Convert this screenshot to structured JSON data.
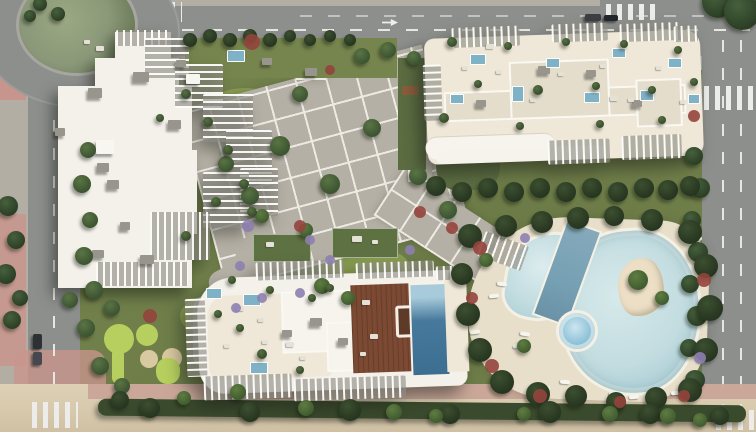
{
  "scene": {
    "description": "Aerial 3D render of a beachfront residential complex: three white apartment buildings with louvered rooftop terraces and plunge pools, a central paved plaza, landscaped gardens, a free-form lagoon pool with lap lane, jacuzzi and palm island, perimeter roads with a roundabout and crosswalks, and a sandy beach strip along the bottom",
    "palette": {
      "road": "#8d8f8c",
      "sidewalk": "#b2aea4",
      "pink": "#c8958c",
      "pinkPath": "#c7a094",
      "building": "#f3f1ea",
      "cream": "#efe7d7",
      "roofVol": "#e4ddcc",
      "roofBox": "#98958c",
      "lawn": "#76854e",
      "lawnBright": "#9cb457",
      "putting": "#b6cf5e",
      "paver": "#b5b0a5",
      "paverLine": "#eceae3",
      "poolLight": "#c2dce0",
      "poolMid": "#7fb2c6",
      "poolLap": "#76a0b4",
      "poolDark": "#47799c",
      "jacuzzi": "#8ec2d8",
      "sandDeck": "#e8dfca",
      "beach": "#d8c9ad",
      "islandSand": "#ecdfc6",
      "wood": "#7c4a33",
      "purple": "#8d80b0",
      "red": "#93443c",
      "greenRoof": "#5e7143",
      "darkLawn": "#5b6c41",
      "hedgeStrip": "#3a4a2c",
      "roundaboutIsland": "#8b9879"
    },
    "treeShades": {
      "dark": [
        "#46603c",
        "#2a3d24"
      ],
      "mid": [
        "#5a7444",
        "#3a5230"
      ],
      "hedge": [
        "#3c4f30",
        "#25341f"
      ],
      "planter": [
        "#55703f",
        "#36492c"
      ],
      "palm": [
        "#5f7c42",
        "#3f5a2e"
      ]
    },
    "vegetation": [
      [
        694,
        156,
        9,
        "dark"
      ],
      [
        700,
        188,
        10,
        "dark"
      ],
      [
        692,
        220,
        9,
        "dark"
      ],
      [
        698,
        252,
        10,
        "dark"
      ],
      [
        690,
        284,
        9,
        "dark"
      ],
      [
        697,
        316,
        10,
        "dark"
      ],
      [
        689,
        348,
        9,
        "dark"
      ],
      [
        695,
        380,
        10,
        "dark"
      ],
      [
        718,
        2,
        16,
        "dark"
      ],
      [
        742,
        12,
        18,
        "dark"
      ],
      [
        8,
        206,
        10,
        "dark"
      ],
      [
        16,
        240,
        9,
        "dark"
      ],
      [
        6,
        274,
        10,
        "dark"
      ],
      [
        20,
        298,
        8,
        "dark"
      ],
      [
        12,
        320,
        9,
        "dark"
      ],
      [
        40,
        4,
        7,
        "dark"
      ],
      [
        58,
        14,
        7,
        "dark"
      ],
      [
        30,
        16,
        6,
        "dark"
      ],
      [
        470,
        236,
        12,
        "hedge"
      ],
      [
        462,
        274,
        11,
        "hedge"
      ],
      [
        468,
        314,
        12,
        "hedge"
      ],
      [
        480,
        350,
        12,
        "hedge"
      ],
      [
        502,
        382,
        12,
        "hedge"
      ],
      [
        538,
        394,
        12,
        "hedge"
      ],
      [
        576,
        396,
        11,
        "hedge"
      ],
      [
        616,
        402,
        10,
        "hedge"
      ],
      [
        656,
        398,
        11,
        "hedge"
      ],
      [
        690,
        390,
        12,
        "hedge"
      ],
      [
        706,
        350,
        12,
        "hedge"
      ],
      [
        710,
        308,
        13,
        "hedge"
      ],
      [
        706,
        266,
        12,
        "hedge"
      ],
      [
        690,
        232,
        12,
        "hedge"
      ],
      [
        652,
        220,
        11,
        "hedge"
      ],
      [
        614,
        216,
        10,
        "hedge"
      ],
      [
        578,
        218,
        11,
        "hedge"
      ],
      [
        542,
        222,
        11,
        "hedge"
      ],
      [
        506,
        226,
        11,
        "hedge"
      ],
      [
        436,
        186,
        10,
        "hedge"
      ],
      [
        462,
        192,
        10,
        "hedge"
      ],
      [
        488,
        188,
        10,
        "hedge"
      ],
      [
        514,
        192,
        10,
        "hedge"
      ],
      [
        540,
        188,
        10,
        "hedge"
      ],
      [
        566,
        192,
        10,
        "hedge"
      ],
      [
        592,
        188,
        10,
        "hedge"
      ],
      [
        618,
        192,
        10,
        "hedge"
      ],
      [
        644,
        188,
        10,
        "hedge"
      ],
      [
        668,
        190,
        10,
        "hedge"
      ],
      [
        690,
        186,
        10,
        "hedge"
      ],
      [
        190,
        40,
        7,
        "hedge"
      ],
      [
        210,
        36,
        7,
        "hedge"
      ],
      [
        230,
        40,
        7,
        "hedge"
      ],
      [
        250,
        36,
        7,
        "hedge"
      ],
      [
        270,
        40,
        7,
        "hedge"
      ],
      [
        290,
        36,
        6,
        "hedge"
      ],
      [
        310,
        40,
        6,
        "hedge"
      ],
      [
        330,
        36,
        6,
        "hedge"
      ],
      [
        350,
        40,
        6,
        "hedge"
      ],
      [
        280,
        146,
        10,
        "mid"
      ],
      [
        330,
        184,
        10,
        "mid"
      ],
      [
        250,
        196,
        9,
        "mid"
      ],
      [
        372,
        128,
        9,
        "mid"
      ],
      [
        418,
        176,
        9,
        "mid"
      ],
      [
        448,
        210,
        9,
        "mid"
      ],
      [
        300,
        94,
        8,
        "mid"
      ],
      [
        226,
        164,
        8,
        "mid"
      ],
      [
        362,
        56,
        8,
        "mid"
      ],
      [
        388,
        50,
        8,
        "mid"
      ],
      [
        414,
        58,
        7,
        "mid"
      ],
      [
        88,
        150,
        8,
        "mid"
      ],
      [
        82,
        184,
        9,
        "mid"
      ],
      [
        90,
        220,
        8,
        "mid"
      ],
      [
        84,
        256,
        9,
        "mid"
      ],
      [
        94,
        290,
        9,
        "mid"
      ],
      [
        112,
        308,
        8,
        "mid"
      ],
      [
        86,
        328,
        9,
        "mid"
      ],
      [
        100,
        366,
        9,
        "mid"
      ],
      [
        122,
        386,
        8,
        "mid"
      ],
      [
        70,
        300,
        8,
        "mid"
      ],
      [
        150,
        408,
        10,
        "hedge"
      ],
      [
        250,
        412,
        10,
        "hedge"
      ],
      [
        350,
        410,
        11,
        "hedge"
      ],
      [
        450,
        414,
        10,
        "hedge"
      ],
      [
        550,
        412,
        11,
        "hedge"
      ],
      [
        650,
        414,
        10,
        "hedge"
      ],
      [
        720,
        416,
        9,
        "hedge"
      ],
      [
        120,
        400,
        9,
        "hedge"
      ],
      [
        322,
        286,
        8,
        "palm"
      ],
      [
        348,
        298,
        7,
        "palm"
      ],
      [
        262,
        216,
        7,
        "palm"
      ],
      [
        306,
        230,
        7,
        "palm"
      ],
      [
        638,
        280,
        10,
        "palm"
      ],
      [
        662,
        298,
        7,
        "palm"
      ],
      [
        486,
        260,
        7,
        "palm"
      ],
      [
        524,
        346,
        7,
        "palm"
      ],
      [
        238,
        392,
        8,
        "palm"
      ],
      [
        306,
        408,
        8,
        "palm"
      ],
      [
        394,
        412,
        8,
        "palm"
      ],
      [
        436,
        416,
        7,
        "palm"
      ],
      [
        524,
        414,
        7,
        "palm"
      ],
      [
        610,
        414,
        8,
        "palm"
      ],
      [
        668,
        416,
        8,
        "palm"
      ],
      [
        700,
        420,
        7,
        "palm"
      ],
      [
        184,
        398,
        7,
        "palm"
      ],
      [
        452,
        42,
        5,
        "planter"
      ],
      [
        478,
        84,
        4,
        "planter"
      ],
      [
        508,
        46,
        4,
        "planter"
      ],
      [
        538,
        90,
        5,
        "planter"
      ],
      [
        566,
        42,
        4,
        "planter"
      ],
      [
        596,
        86,
        4,
        "planter"
      ],
      [
        624,
        44,
        4,
        "planter"
      ],
      [
        652,
        90,
        4,
        "planter"
      ],
      [
        678,
        50,
        4,
        "planter"
      ],
      [
        694,
        82,
        4,
        "planter"
      ],
      [
        444,
        118,
        5,
        "planter"
      ],
      [
        520,
        126,
        4,
        "planter"
      ],
      [
        600,
        124,
        4,
        "planter"
      ],
      [
        662,
        120,
        4,
        "planter"
      ],
      [
        232,
        280,
        4,
        "planter"
      ],
      [
        270,
        290,
        4,
        "planter"
      ],
      [
        312,
        298,
        4,
        "planter"
      ],
      [
        240,
        328,
        4,
        "planter"
      ],
      [
        262,
        354,
        5,
        "planter"
      ],
      [
        300,
        370,
        4,
        "planter"
      ],
      [
        330,
        288,
        4,
        "planter"
      ],
      [
        218,
        314,
        4,
        "planter"
      ],
      [
        186,
        94,
        5,
        "planter"
      ],
      [
        208,
        122,
        5,
        "planter"
      ],
      [
        228,
        150,
        5,
        "planter"
      ],
      [
        244,
        184,
        5,
        "planter"
      ],
      [
        252,
        212,
        5,
        "planter"
      ],
      [
        216,
        202,
        5,
        "planter"
      ],
      [
        186,
        236,
        5,
        "planter"
      ],
      [
        160,
        118,
        4,
        "planter"
      ]
    ],
    "flowers": [
      [
        248,
        226,
        6,
        "purple"
      ],
      [
        310,
        240,
        5,
        "purple"
      ],
      [
        330,
        260,
        5,
        "purple"
      ],
      [
        300,
        293,
        5,
        "purple"
      ],
      [
        262,
        298,
        5,
        "purple"
      ],
      [
        240,
        266,
        5,
        "purple"
      ],
      [
        525,
        238,
        5,
        "purple"
      ],
      [
        700,
        358,
        6,
        "purple"
      ],
      [
        410,
        250,
        5,
        "purple"
      ],
      [
        236,
        308,
        5,
        "purple"
      ],
      [
        252,
        42,
        8,
        "red"
      ],
      [
        150,
        316,
        7,
        "red"
      ],
      [
        480,
        248,
        7,
        "red"
      ],
      [
        472,
        298,
        6,
        "red"
      ],
      [
        492,
        366,
        7,
        "red"
      ],
      [
        540,
        396,
        7,
        "red"
      ],
      [
        620,
        402,
        6,
        "red"
      ],
      [
        684,
        396,
        6,
        "red"
      ],
      [
        704,
        280,
        7,
        "red"
      ],
      [
        452,
        228,
        6,
        "red"
      ],
      [
        300,
        226,
        6,
        "red"
      ],
      [
        420,
        212,
        6,
        "red"
      ],
      [
        694,
        116,
        6,
        "red"
      ],
      [
        330,
        70,
        5,
        "red"
      ]
    ],
    "roofBoxes": [
      [
        88,
        88,
        14,
        10,
        "g"
      ],
      [
        133,
        72,
        16,
        10,
        "g"
      ],
      [
        97,
        163,
        12,
        9,
        "g"
      ],
      [
        107,
        180,
        12,
        9,
        "g"
      ],
      [
        55,
        128,
        10,
        8,
        "g"
      ],
      [
        168,
        120,
        13,
        9,
        "g"
      ],
      [
        92,
        250,
        12,
        8,
        "g"
      ],
      [
        140,
        255,
        14,
        9,
        "g"
      ],
      [
        120,
        222,
        10,
        8,
        "g"
      ],
      [
        176,
        60,
        10,
        7,
        "g"
      ],
      [
        305,
        68,
        12,
        8,
        "g"
      ],
      [
        262,
        58,
        10,
        7,
        "g"
      ],
      [
        538,
        66,
        12,
        8,
        "g"
      ],
      [
        586,
        70,
        10,
        7,
        "g"
      ],
      [
        476,
        100,
        10,
        7,
        "g"
      ],
      [
        632,
        100,
        10,
        7,
        "g"
      ],
      [
        310,
        318,
        12,
        8,
        "g"
      ],
      [
        282,
        330,
        10,
        7,
        "g"
      ],
      [
        338,
        338,
        10,
        7,
        "g"
      ],
      [
        96,
        140,
        18,
        14,
        "w"
      ],
      [
        186,
        74,
        14,
        10,
        "w"
      ]
    ],
    "miniPools": [
      [
        227,
        50,
        16,
        10
      ],
      [
        470,
        54,
        14,
        9
      ],
      [
        512,
        86,
        10,
        14
      ],
      [
        546,
        58,
        12,
        8
      ],
      [
        584,
        92,
        14,
        9
      ],
      [
        612,
        48,
        12,
        8
      ],
      [
        640,
        90,
        12,
        9
      ],
      [
        668,
        58,
        12,
        8
      ],
      [
        688,
        94,
        10,
        8
      ],
      [
        450,
        94,
        12,
        8
      ],
      [
        243,
        294,
        16,
        10
      ],
      [
        250,
        362,
        16,
        10
      ],
      [
        206,
        288,
        14,
        9
      ]
    ],
    "furniture": [
      [
        462,
        66,
        6,
        4
      ],
      [
        496,
        70,
        6,
        4
      ],
      [
        530,
        98,
        6,
        4
      ],
      [
        558,
        72,
        6,
        4
      ],
      [
        600,
        64,
        6,
        4
      ],
      [
        628,
        98,
        6,
        4
      ],
      [
        656,
        66,
        6,
        4
      ],
      [
        680,
        100,
        6,
        4
      ],
      [
        486,
        44,
        8,
        5
      ],
      [
        610,
        96,
        8,
        5
      ],
      [
        236,
        306,
        8,
        5
      ],
      [
        258,
        318,
        6,
        4
      ],
      [
        286,
        342,
        8,
        5
      ],
      [
        262,
        340,
        6,
        4
      ],
      [
        224,
        344,
        6,
        4
      ],
      [
        300,
        356,
        6,
        4
      ],
      [
        362,
        300,
        8,
        5
      ],
      [
        370,
        334,
        8,
        5
      ],
      [
        360,
        352,
        6,
        4
      ],
      [
        96,
        46,
        8,
        5
      ],
      [
        84,
        40,
        6,
        4
      ],
      [
        266,
        242,
        8,
        5
      ],
      [
        352,
        236,
        10,
        6
      ],
      [
        372,
        240,
        6,
        4
      ]
    ],
    "loungers": [
      [
        497,
        282,
        8
      ],
      [
        489,
        294,
        -6
      ],
      [
        520,
        332,
        10
      ],
      [
        513,
        344,
        -8
      ],
      [
        609,
        392,
        4
      ],
      [
        629,
        395,
        -4
      ],
      [
        651,
        394,
        5
      ],
      [
        671,
        391,
        -5
      ],
      [
        692,
        236,
        12
      ],
      [
        684,
        224,
        -10
      ],
      [
        540,
        386,
        6
      ],
      [
        470,
        330,
        -8
      ],
      [
        560,
        380,
        5
      ]
    ],
    "cars": [
      [
        585,
        14,
        16,
        7,
        "#3b3e44"
      ],
      [
        604,
        15,
        14,
        6,
        "#22252a"
      ],
      [
        33,
        334,
        9,
        15,
        "#2e3134"
      ],
      [
        33,
        352,
        9,
        13,
        "#45484e"
      ],
      [
        62,
        26,
        11,
        5,
        "#555a60"
      ]
    ]
  }
}
